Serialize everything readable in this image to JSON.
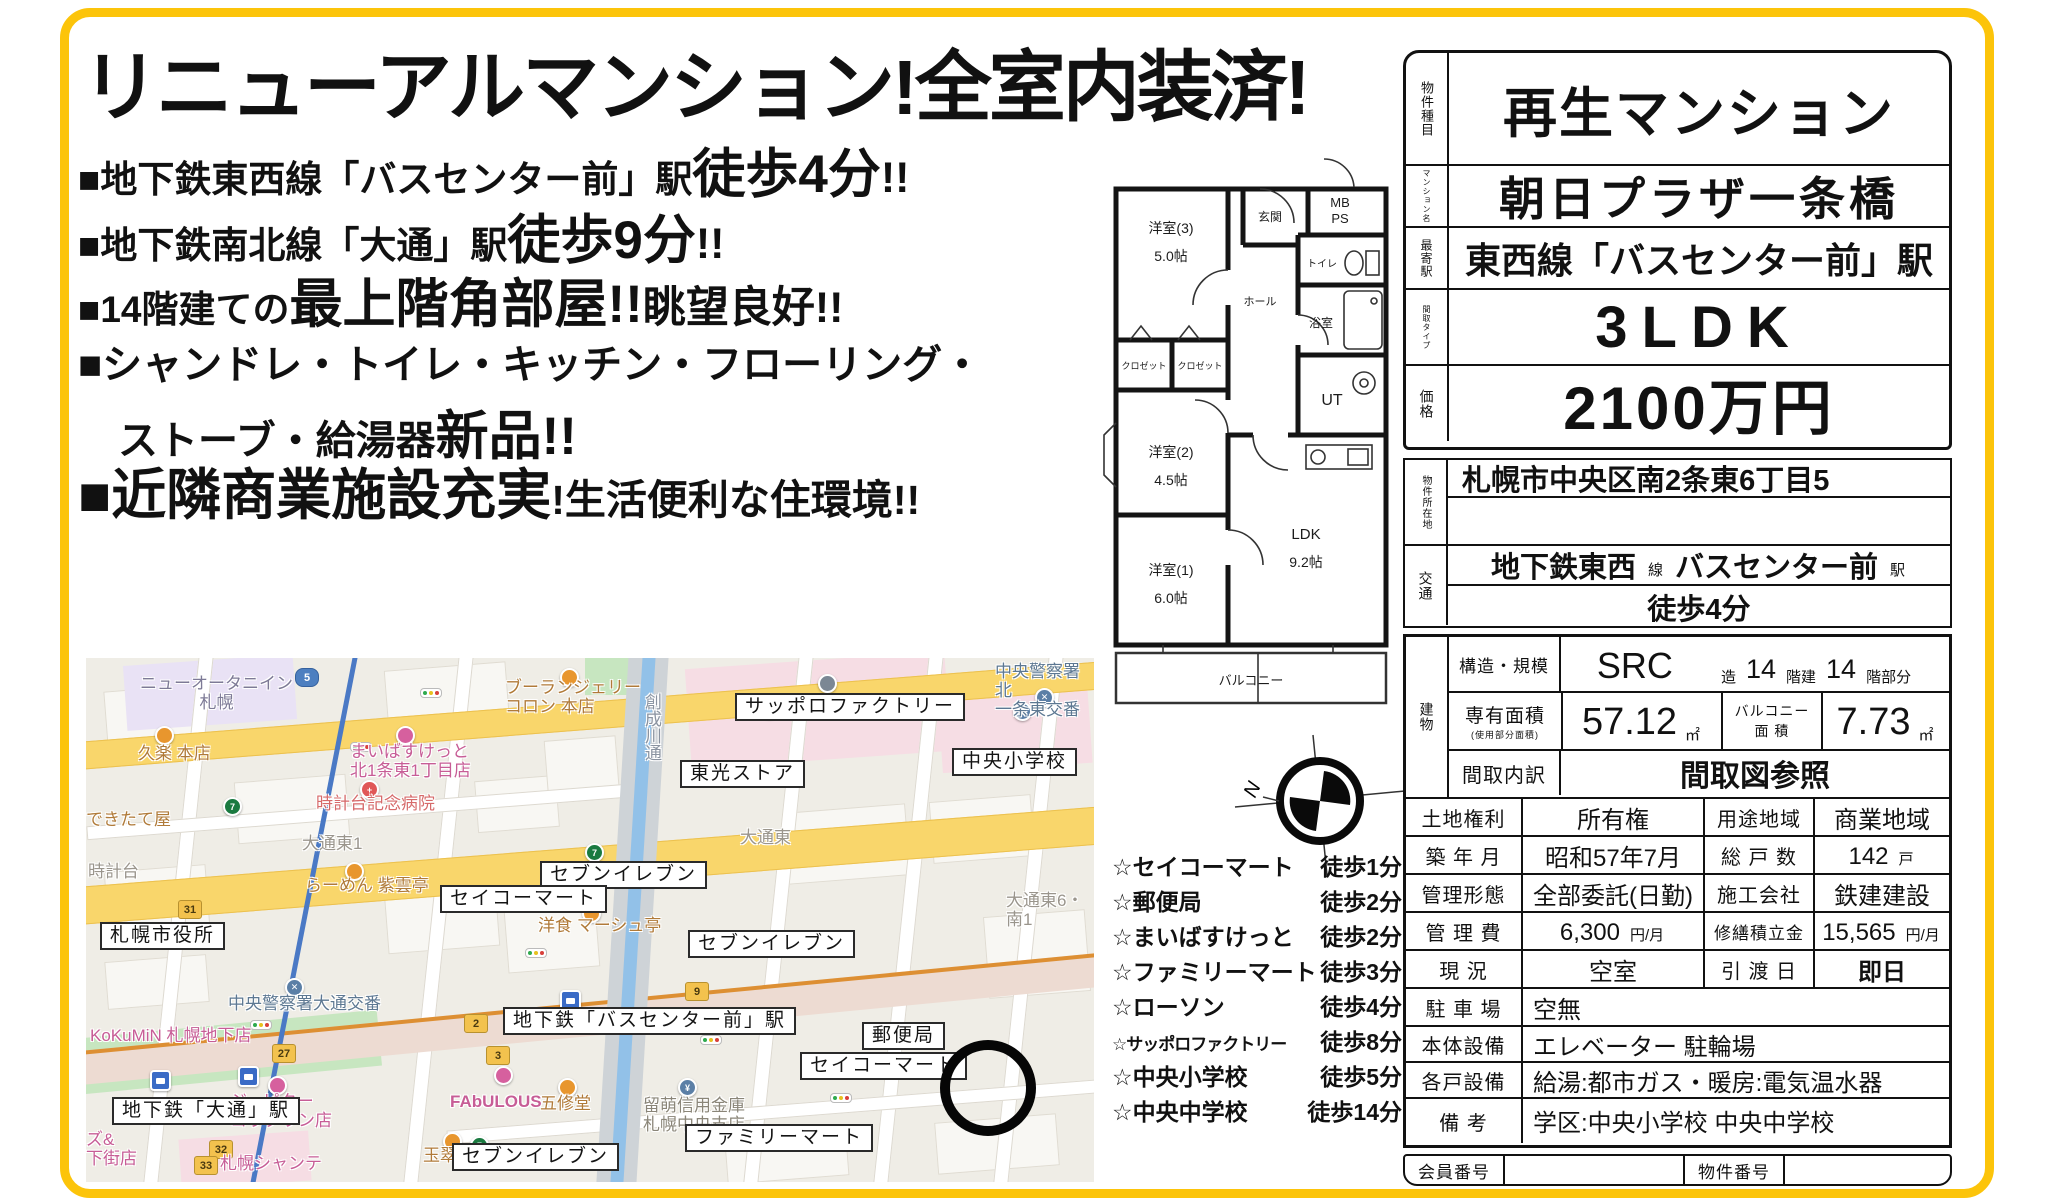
{
  "colors": {
    "frame_yellow": "#fcc40a",
    "road_yellow": "#f9d66b",
    "map_pink_area": "#f6dde4",
    "river_blue": "#92c1e8",
    "subway_orange": "#e09033",
    "subway_blue": "#4a79c5"
  },
  "flyer": {
    "headline": "リニューアルマンション!全室内装済!",
    "bullets": [
      {
        "pre": "■地下鉄東西線「バスセンター前」駅",
        "big": "徒歩4分",
        "post": "!!"
      },
      {
        "pre": "■地下鉄南北線「大通」駅",
        "big": "徒歩9分",
        "post": "!!"
      },
      {
        "pre": "■14階建ての",
        "big": "最上階角部屋!!",
        "post": "眺望良好!!"
      },
      {
        "pre": "■シャンドレ・トイレ・キッチン・フローリング・",
        "big": "",
        "post": ""
      },
      {
        "pre": "ストーブ・給湯器",
        "big": "新品!!",
        "post": ""
      },
      {
        "pre": "",
        "big": "■近隣商業施設充実",
        "post": "!生活便利な住環境!!"
      }
    ]
  },
  "floorplan": {
    "rooms": {
      "west3": "洋室(3)",
      "west3_size": "5.0帖",
      "closet1": "クロゼット",
      "closet2": "クロゼット",
      "west2": "洋室(2)",
      "west2_size": "4.5帖",
      "west1": "洋室(1)",
      "west1_size": "6.0帖",
      "ldk": "LDK",
      "ldk_size": "9.2帖",
      "genkan": "玄関",
      "hall": "ホール",
      "mb": "MB",
      "ps": "PS",
      "toilet": "トイレ",
      "bath": "浴室",
      "ut": "UT",
      "balcony": "バルコニー"
    },
    "compass_n": "N"
  },
  "walklist": {
    "items": [
      {
        "name": "☆セイコーマート",
        "time": "徒歩1分"
      },
      {
        "name": "☆郵便局",
        "time": "徒歩2分"
      },
      {
        "name": "☆まいばすけっと",
        "time": "徒歩2分"
      },
      {
        "name": "☆ファミリーマート",
        "time": "徒歩3分"
      },
      {
        "name": "☆ローソン",
        "time": "徒歩4分"
      },
      {
        "name": "☆サッポロファクトリー",
        "time": "徒歩8分"
      },
      {
        "name": "☆中央小学校",
        "time": "徒歩5分"
      },
      {
        "name": "☆中央中学校",
        "time": "徒歩14分"
      }
    ]
  },
  "map": {
    "boxed": [
      "サッポロファクトリー",
      "東光ストア",
      "セブンイレブン",
      "セイコーマート",
      "セブンイレブン",
      "中央小学校",
      "札幌市役所",
      "地下鉄「バスセンター前」駅",
      "郵便局",
      "セイコーマート",
      "地下鉄「大通」駅",
      "ファミリーマート",
      "セブンイレブン"
    ],
    "labels": [
      "ニューオータニイン\n札幌",
      "久楽 本店",
      "ブーランジェリー\nコロン 本店",
      "まいばすけっと\n北1条東1丁目店",
      "時計台記念病院",
      "大通東1",
      "できたて屋",
      "時計台",
      "らーめん 紫雲亭",
      "中央警察署大通交番",
      "KoKuMiN 札幌地下店",
      "洋食 マーシュ亭",
      "ジュピター\nコラタウン店",
      "札幌シャンテ",
      "ズ&\n下街店",
      "FAbULOUS",
      "五修堂",
      "玉翠園",
      "留萌信用金庫\n札幌中央支店",
      "大通東",
      "中央警察署北\n一条東交番",
      "大通東6・南1",
      "創成川通"
    ],
    "shields": [
      "5",
      "31",
      "27",
      "2",
      "3",
      "32",
      "33",
      "9"
    ]
  },
  "table": {
    "headers": {
      "type": "物件種目",
      "name": "マンション名",
      "station": "最寄駅",
      "layout": "間取タイプ",
      "price": "価格",
      "address": "物件所在地",
      "access": "交通",
      "building": "建物"
    },
    "type_value": "再生マンション",
    "name_value": "朝日プラザ一条橋",
    "station_value": "東西線「バスセンター前」駅",
    "layout_value": "3LDK",
    "price_value": "2100万円",
    "address_value": "札幌市中央区南2条東6丁目5",
    "access_line": "地下鉄東西",
    "access_line_unit": "線",
    "access_station": "バスセンター前",
    "access_station_unit": "駅",
    "access_walk": "徒歩4分",
    "rows": {
      "structure_label": "構造・規模",
      "structure_value": "SRC",
      "structure_unit1": "造",
      "structure_floors": "14",
      "structure_unit2": "階建",
      "structure_part": "14",
      "structure_unit3": "階部分",
      "area_label": "専有面積",
      "area_sublabel": "(使用部分面積)",
      "area_value": "57.12",
      "area_unit": "㎡",
      "balcony_label": "バルコニー\n面 積",
      "balcony_value": "7.73",
      "balcony_unit": "㎡",
      "madori_label": "間取内訳",
      "madori_value": "間取図参照",
      "land_label": "土地権利",
      "land_value": "所有権",
      "youto_label": "用途地域",
      "youto_value": "商業地域",
      "built_label": "築 年 月",
      "built_value": "昭和57年7月",
      "units_label": "総 戸 数",
      "units_value": "142",
      "units_unit": "戸",
      "mgmt_label": "管理形態",
      "mgmt_value": "全部委託(日勤)",
      "builder_label": "施工会社",
      "builder_value": "鉄建建設",
      "fee_label": "管 理 費",
      "fee_value": "6,300",
      "fee_unit": "円/月",
      "repair_label": "修繕積立金",
      "repair_value": "15,565",
      "repair_unit": "円/月",
      "status_label": "現  況",
      "status_value": "空室",
      "handover_label": "引 渡 日",
      "handover_value": "即日",
      "parking_label": "駐 車 場",
      "parking_value": "空無",
      "facility_label": "本体設備",
      "facility_value": "エレベーター 駐輪場",
      "unit_fac_label": "各戸設備",
      "unit_fac_value": "給湯:都市ガス・暖房:電気温水器",
      "notes_label": "備  考",
      "notes_value": "学区:中央小学校 中央中学校",
      "member_label": "会員番号",
      "bukken_label": "物件番号"
    }
  }
}
